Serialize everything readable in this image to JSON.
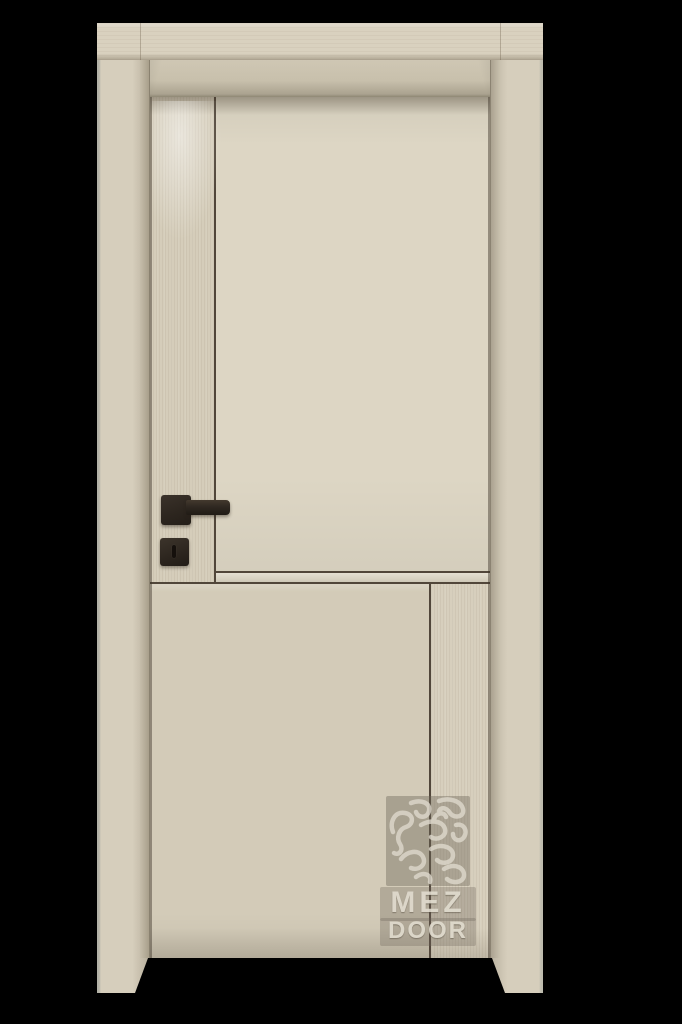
{
  "scene": {
    "description": "3D product render of a cream-laminate interior door with black square lever handle and privacy lock, set in a matching wood frame on a black background",
    "background_color": "#000000"
  },
  "door": {
    "leaf_color": "#d8d1bf",
    "frame_color": "#d6cebc",
    "groove_color": "#51463a",
    "hardware_color": "#2e2720",
    "panels": [
      "upper-left-stile",
      "upper-right-panel",
      "lower-left-panel",
      "lower-right-stile"
    ]
  },
  "watermark": {
    "line1": "MEZ",
    "line2": "DOOR",
    "text_color": "#ddd8cb",
    "panel_color": "#6c6558"
  }
}
